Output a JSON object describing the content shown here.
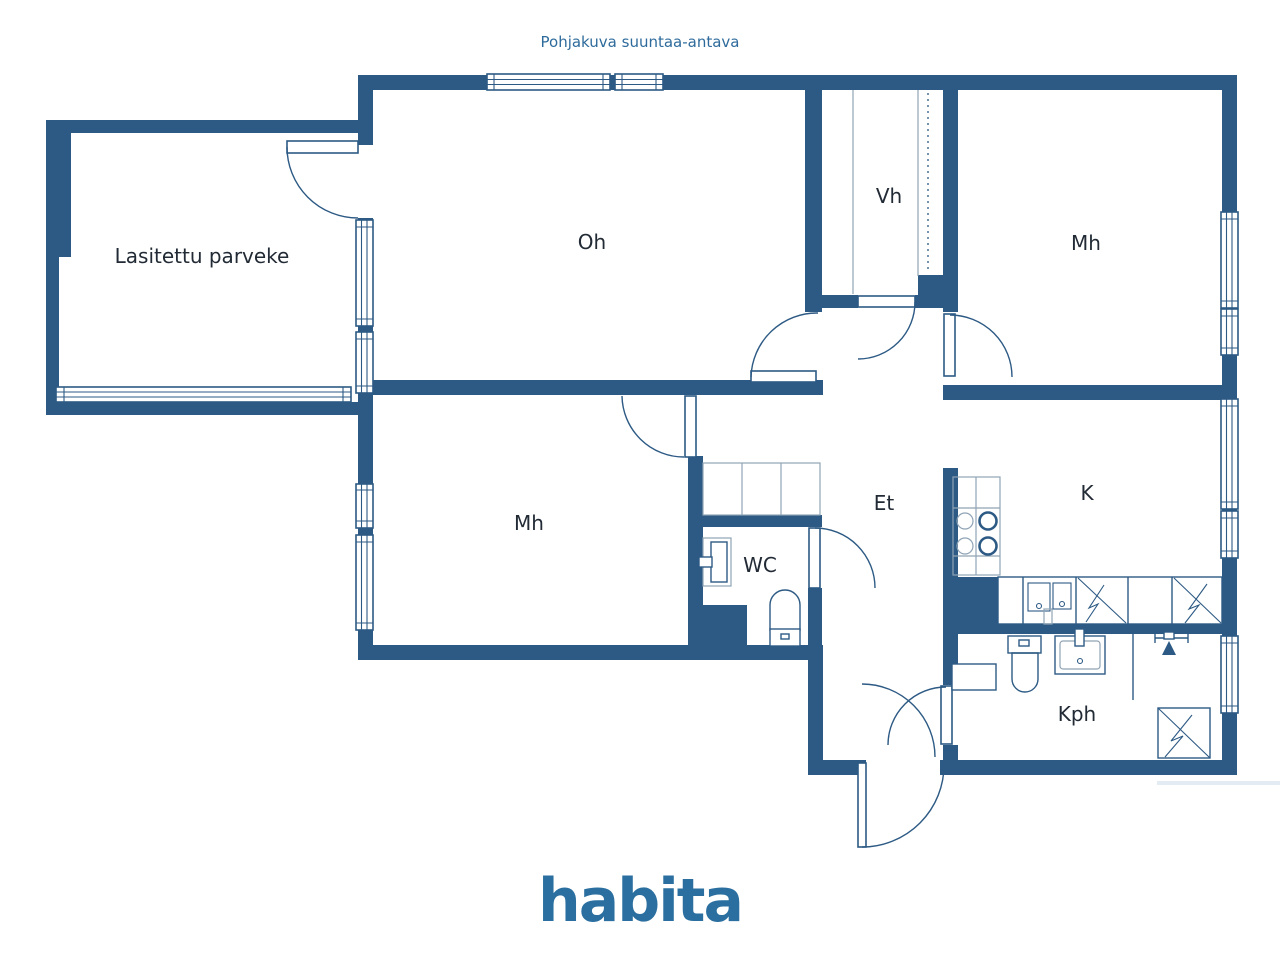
{
  "title": "Pohjakuva suuntaa-antava",
  "rooms": {
    "balcony": "Lasitettu parveke",
    "living": "Oh",
    "closet": "Vh",
    "bedroom_top": "Mh",
    "bedroom_bottom": "Mh",
    "hall": "Et",
    "wc": "WC",
    "kitchen": "K",
    "bathroom": "Kph"
  },
  "logo": "habita",
  "colors": {
    "wall": "#2d5a84",
    "accent": "#2e6b9c",
    "logo": "#2a6f9f",
    "label": "#222b35",
    "light": "#8fa3b5"
  }
}
